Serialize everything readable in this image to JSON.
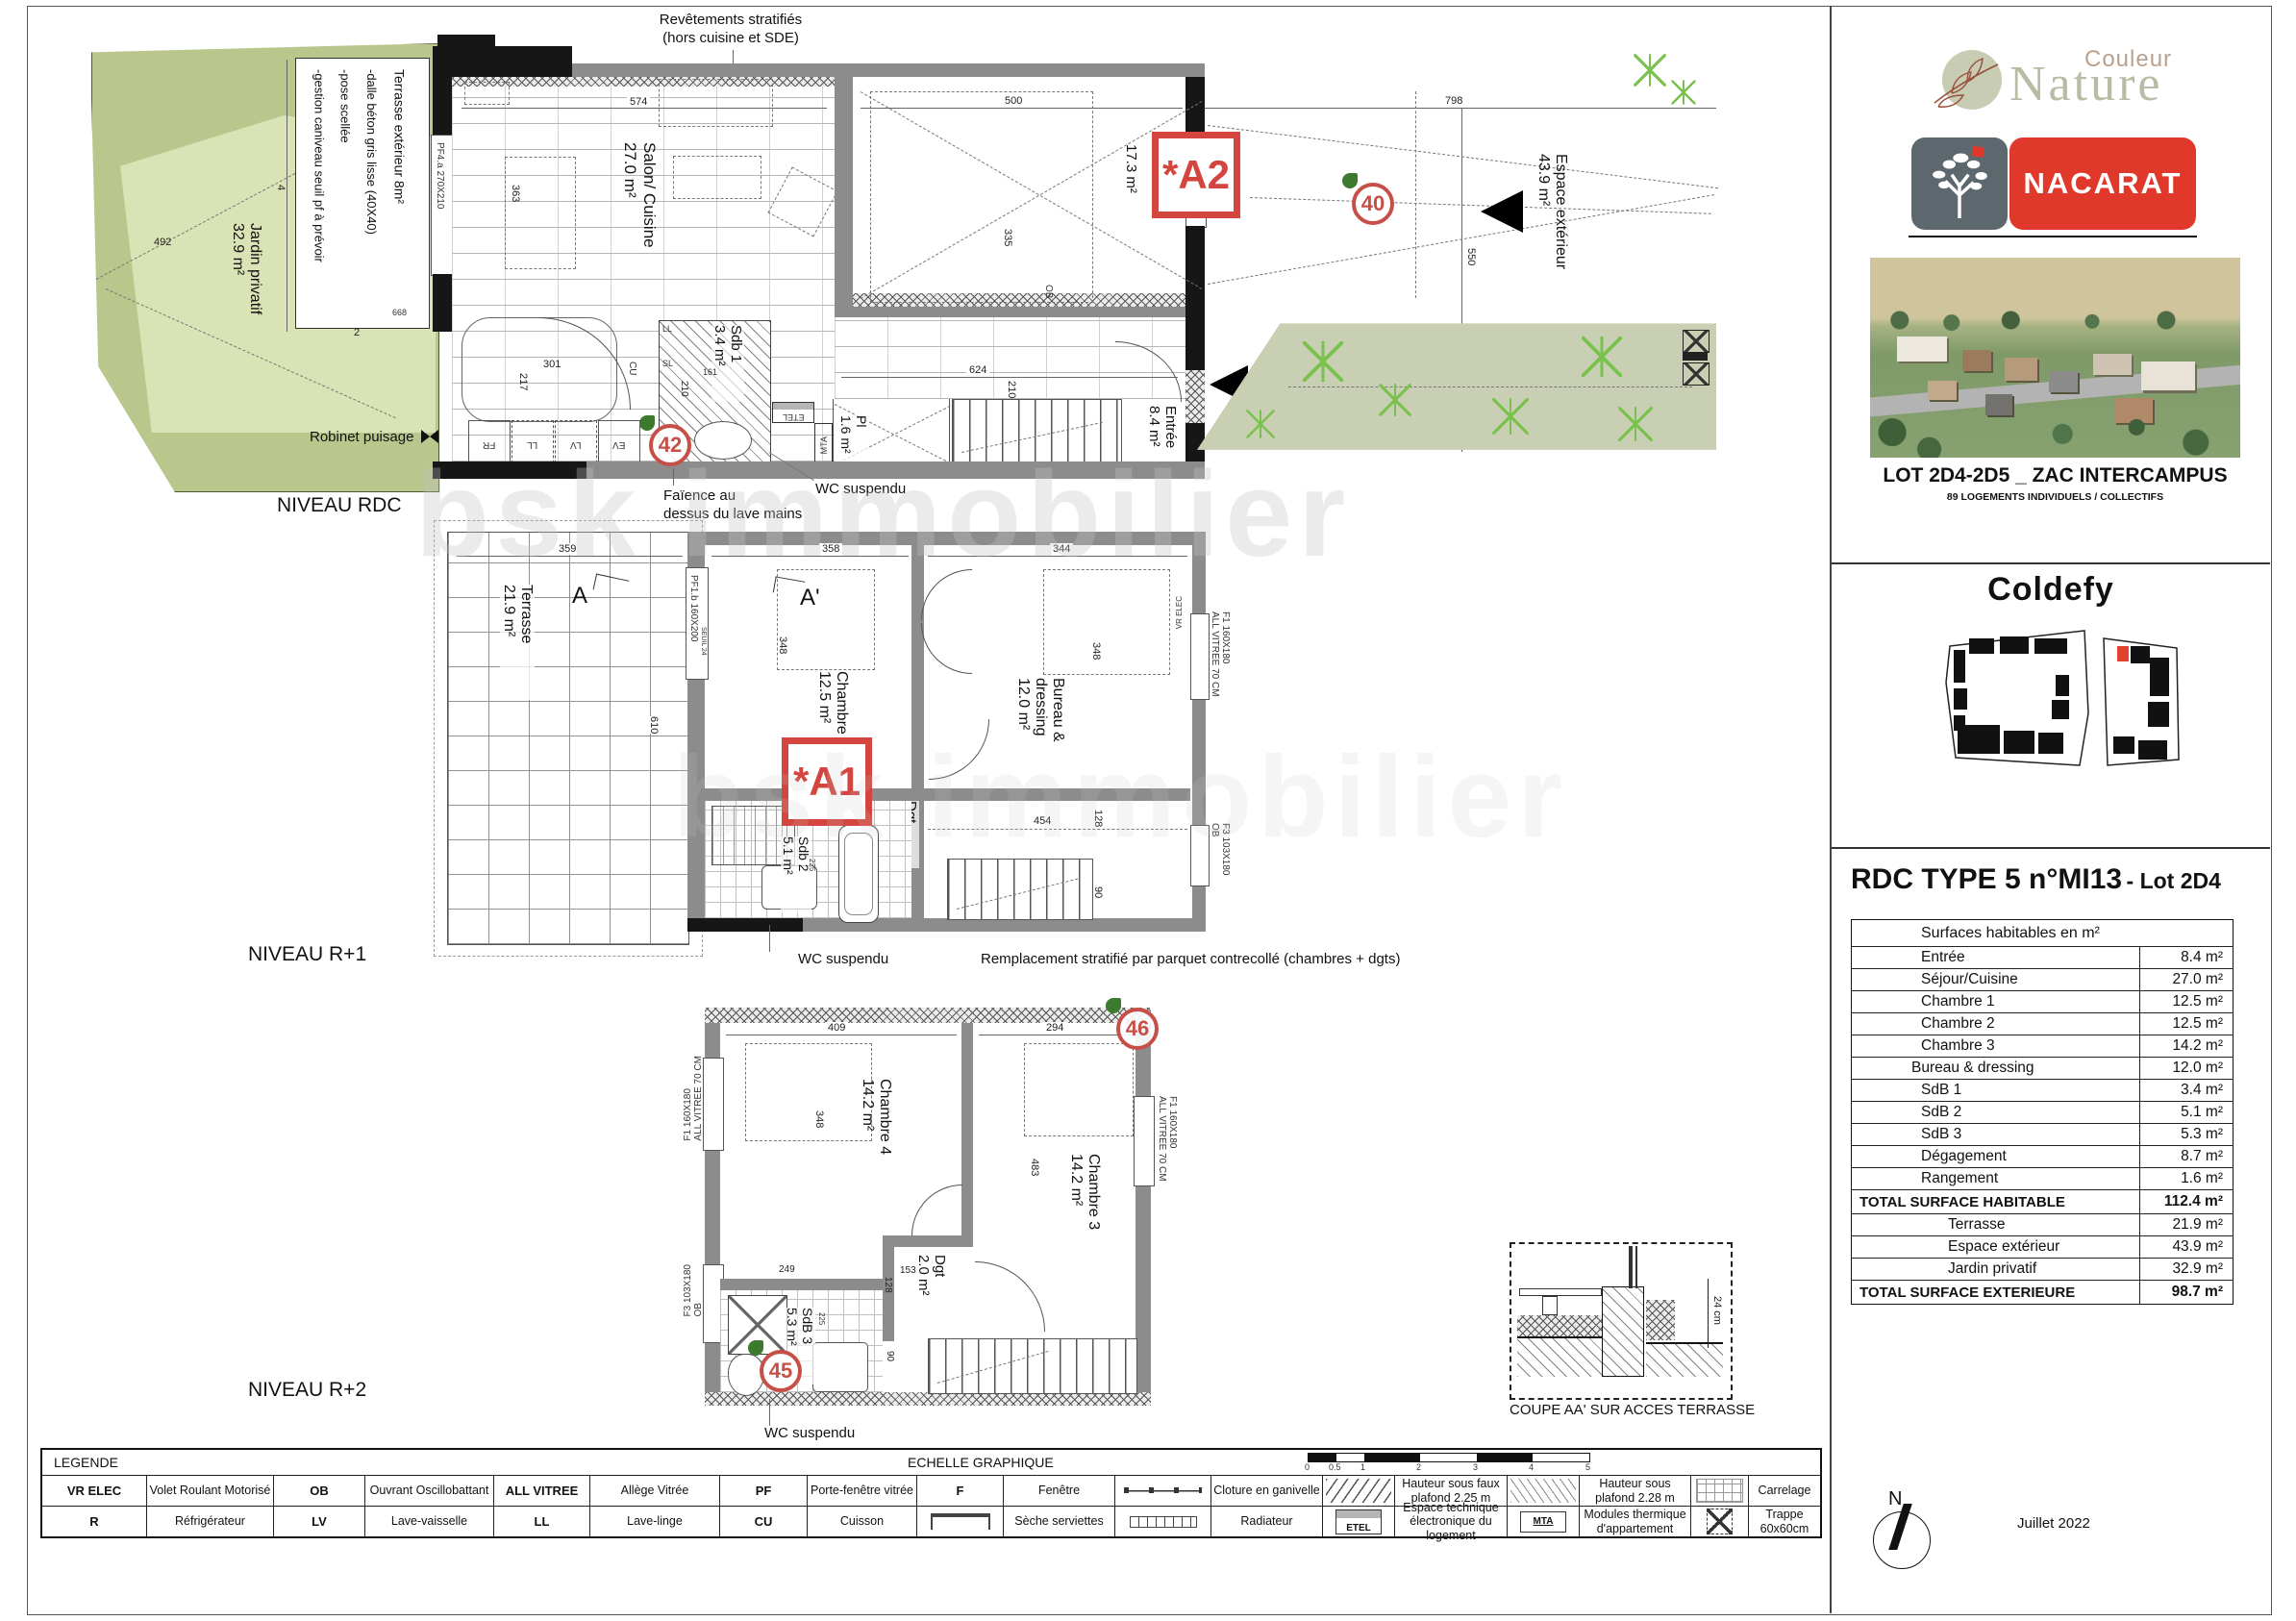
{
  "colors": {
    "accent_red": "#d3453e",
    "nacarat_red": "#e0392b",
    "nacarat_gray": "#5c676e",
    "garden_dark": "#b9c78c",
    "garden_light": "#d9e3b6",
    "planted_band": "#c9cfb3",
    "wall_gray": "#8c8c8c"
  },
  "watermark": "bsk immobilier",
  "annotations": {
    "revetements_l1": "Revêtements stratifiés",
    "revetements_l2": "(hors cuisine et SDE)",
    "faience_l1": "Faïence au",
    "faience_l2": "dessus du lave mains",
    "wc": "WC suspendu",
    "remplacement": "Remplacement stratifié par parquet contrecollé (chambres + dgts)",
    "robinet": "Robinet puisage",
    "coupe_title": "COUPE AA' SUR ACCES TERRASSE",
    "coupe_dim": "24 cm",
    "niveau_rdc": "NIVEAU RDC",
    "niveau_r1": "NIVEAU R+1",
    "niveau_r2": "NIVEAU R+2"
  },
  "rdc": {
    "badge": "*A2",
    "marker_40": "40",
    "marker_42": "42",
    "jardin_l1": "Jardin privatif",
    "jardin_l2": "32.9 m²",
    "note_l1": "Terrasse extérieur 8m²",
    "note_l2": "-dalle béton gris lisse (40X40)",
    "note_l3": "-pose scellée",
    "note_l4": "-gestion caniveau seuil pf à prévoir",
    "salon_l1": "Salon/ Cuisine",
    "salon_l2": "27.0 m²",
    "sdb1_l1": "Sdb 1",
    "sdb1_l2": "3.4 m²",
    "pl_l1": "Pl",
    "pl_l2": "1.6 m²",
    "entree_l1": "Entrée",
    "entree_l2": "8.4 m²",
    "garage_area": "17.3 m²",
    "espace_l1": "Espace extérieur",
    "espace_l2": "43.9 m²",
    "pf4": "PF4.a 270X210",
    "pf2": "PF2.a 103X210",
    "vr_elec": "VR ELEC",
    "ob": "OB",
    "cu": "CU",
    "lv": "LV",
    "ll": "LL",
    "fr": "FR",
    "ev": "EV",
    "sl": "SL",
    "etel": "ETEL",
    "mta": "MTA",
    "d574": "574",
    "d363": "363",
    "d500": "500",
    "d335": "335",
    "d798": "798",
    "d550": "550",
    "d624": "624",
    "d210a": "210",
    "d210b": "210",
    "d161": "161",
    "d301": "301",
    "d217": "217",
    "d492": "492",
    "d4": "4",
    "d2": "2",
    "d668": "668"
  },
  "r1": {
    "badge": "*A1",
    "terrasse_l1": "Terrasse",
    "terrasse_l2": "21.9 m²",
    "section_a": "A",
    "section_ap": "A'",
    "chambre_l1": "Chambre 1",
    "chambre_l2": "12.5 m²",
    "bureau_l1": "Bureau &",
    "bureau_l2": "dressing",
    "bureau_l3": "12.0 m²",
    "sdb2_l1": "Sdb 2",
    "sdb2_l2": "5.1 m²",
    "dgt_l1": "Dgt",
    "dgt_l2": "6.7 m²",
    "pf1": "PF1.b 160X200",
    "seuil": "SEUIL 24",
    "f1": "F1 160X180",
    "allvitree": "ALL VITREE 70 CM",
    "f3": "F3 103X180",
    "ob": "OB",
    "vr_elec": "VR ELEC",
    "d359": "359",
    "d610": "610",
    "d358": "358",
    "d344": "344",
    "d348a": "348",
    "d348b": "348",
    "d454": "454",
    "d128": "128",
    "d90": "90",
    "d225": "225"
  },
  "r2": {
    "marker_45": "45",
    "marker_46": "46",
    "chambre4_l1": "Chambre 4",
    "chambre4_l2": "14.2 m²",
    "chambre3_l1": "Chambre 3",
    "chambre3_l2": "14.2 m²",
    "dgt_l1": "Dgt",
    "dgt_l2": "2.0 m²",
    "sdb3_l1": "SdB 3",
    "sdb3_l2": "5.3 m²",
    "f1a": "F1 160X180",
    "allvitree_a": "ALL VITREE 70 CM",
    "f1b": "F1 160X180",
    "allvitree_b": "ALL VITREE 70 CM",
    "f3": "F3 103X180",
    "ob": "OB",
    "d409": "409",
    "d294": "294",
    "d348": "348",
    "d483": "483",
    "d249": "249",
    "d153": "153",
    "d128": "128",
    "d225": "225",
    "d90": "90"
  },
  "legend": {
    "title": "LEGENDE",
    "echelle": "ECHELLE GRAPHIQUE",
    "scale_ticks": [
      "0",
      "0.5",
      "1",
      "2",
      "3",
      "4",
      "5"
    ],
    "row1": [
      {
        "abbr": "VR ELEC",
        "label": "Volet Roulant Motorisé"
      },
      {
        "abbr": "OB",
        "label": "Ouvrant Oscillobattant"
      },
      {
        "abbr": "ALL VITREE",
        "label": "Allège Vitrée"
      },
      {
        "abbr": "PF",
        "label": "Porte-fenêtre vitrée"
      },
      {
        "abbr": "F",
        "label": "Fenêtre"
      },
      {
        "abbr": "",
        "label": "Cloture en ganivelle"
      },
      {
        "abbr": "",
        "label": "Hauteur sous faux plafond 2.25 m"
      },
      {
        "abbr": "",
        "label": "Hauteur sous plafond 2.28 m"
      },
      {
        "abbr": "",
        "label": "Carrelage"
      }
    ],
    "row2": [
      {
        "abbr": "R",
        "label": "Réfrigérateur"
      },
      {
        "abbr": "LV",
        "label": "Lave-vaisselle"
      },
      {
        "abbr": "LL",
        "label": "Lave-linge"
      },
      {
        "abbr": "CU",
        "label": "Cuisson"
      },
      {
        "abbr": "",
        "label": "Sèche serviettes"
      },
      {
        "abbr": "",
        "label": "Radiateur"
      },
      {
        "abbr": "ETEL",
        "label": "Espace technique électronique du logement"
      },
      {
        "abbr": "MTA",
        "label": "Modules thermique d'appartement"
      },
      {
        "abbr": "",
        "label": "Trappe 60x60cm"
      }
    ]
  },
  "panel": {
    "brand_couleur": "Couleur",
    "brand_nature": "Nature",
    "brand_nacarat": "NACARAT",
    "lot_title": "LOT 2D4-2D5 _ ZAC INTERCAMPUS",
    "lot_subtitle": "89 LOGEMENTS INDIVIDUELS / COLLECTIFS",
    "architect": "Coldefy",
    "plan_title": "RDC  TYPE 5 n°MI13",
    "plan_title_suffix": "- Lot 2D4",
    "date": "Juillet 2022",
    "north_label": "N",
    "table": {
      "header": "Surfaces habitables en m²",
      "rows": [
        {
          "label": "Entrée",
          "value": "8.4 m²"
        },
        {
          "label": "Séjour/Cuisine",
          "value": "27.0 m²"
        },
        {
          "label": "Chambre 1",
          "value": "12.5 m²"
        },
        {
          "label": "Chambre 2",
          "value": "12.5 m²"
        },
        {
          "label": "Chambre 3",
          "value": "14.2 m²"
        },
        {
          "label": "Bureau & dressing",
          "value": "12.0 m²"
        },
        {
          "label": "SdB 1",
          "value": "3.4 m²"
        },
        {
          "label": "SdB 2",
          "value": "5.1 m²"
        },
        {
          "label": "SdB 3",
          "value": "5.3 m²"
        },
        {
          "label": "Dégagement",
          "value": "8.7 m²"
        },
        {
          "label": "Rangement",
          "value": "1.6 m²"
        }
      ],
      "total_hab": {
        "label": "TOTAL SURFACE HABITABLE",
        "value": "112.4 m²"
      },
      "ext_rows": [
        {
          "label": "Terrasse",
          "value": "21.9 m²"
        },
        {
          "label": "Espace extérieur",
          "value": "43.9 m²"
        },
        {
          "label": "Jardin privatif",
          "value": "32.9 m²"
        }
      ],
      "total_ext": {
        "label": "TOTAL SURFACE EXTERIEURE",
        "value": "98.7 m²"
      }
    }
  }
}
